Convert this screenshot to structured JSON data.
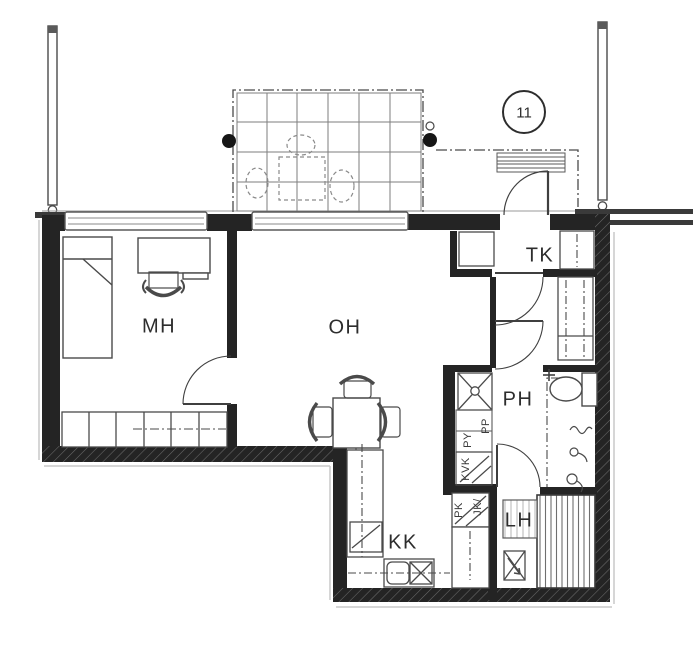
{
  "plan": {
    "unit_number": "11",
    "rooms": {
      "bedroom": "MH",
      "living_room": "OH",
      "vestibule": "TK",
      "bathroom": "PH",
      "kitchenette": "KK",
      "sauna": "LH"
    },
    "appliances": {
      "washing_machine": "PP",
      "laundry_cabinet": "PY",
      "cold_cabinet": "KVK",
      "fridge": "JK/",
      "freezer": "PK"
    },
    "colors": {
      "paper": "#ffffff",
      "wall": "#242424",
      "line": "#3f3f3f",
      "light_line": "#8f8f8f"
    }
  }
}
